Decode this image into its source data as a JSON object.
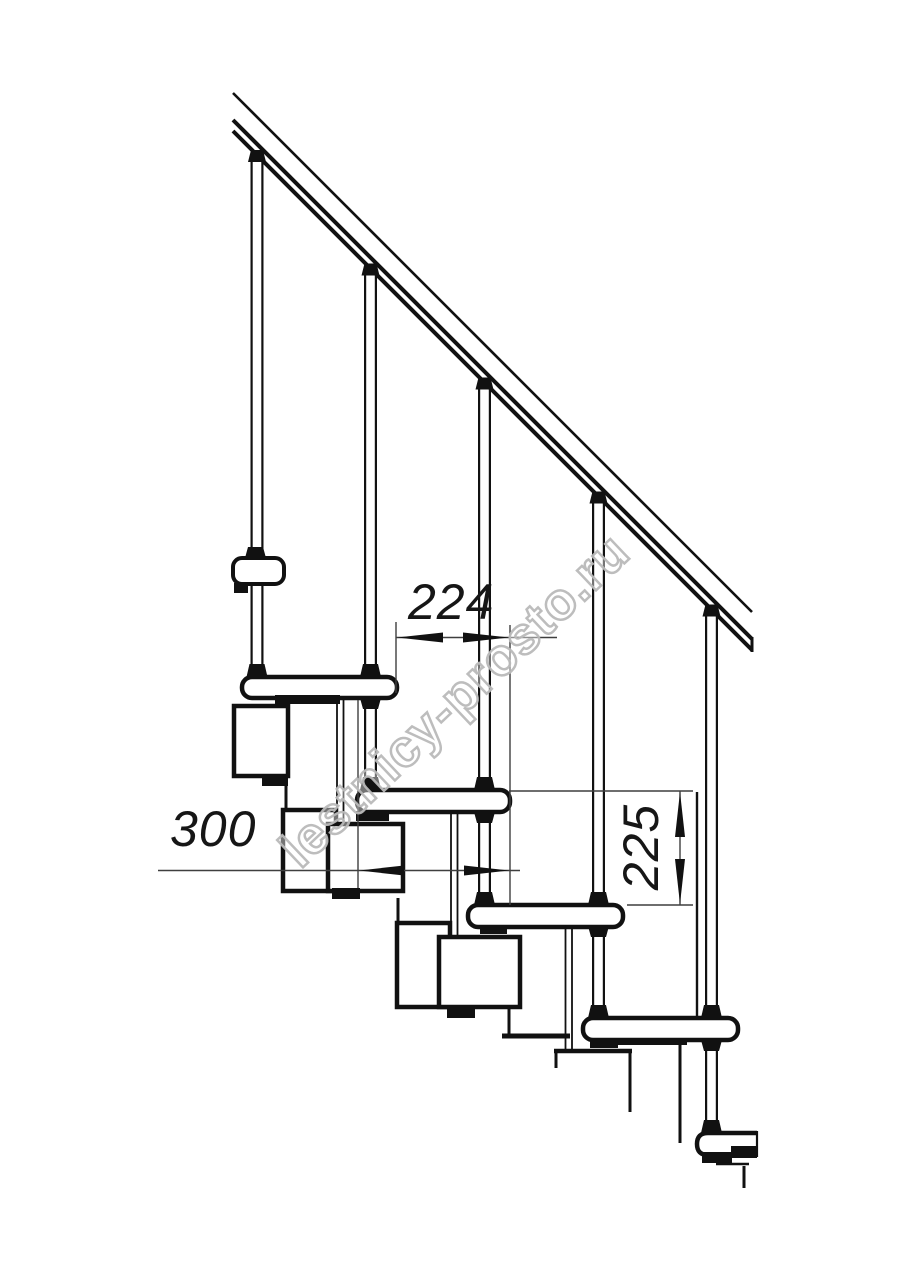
{
  "drawing": {
    "watermark": "lestnicy-prosto.ru",
    "dimensions": {
      "run": "224",
      "depth": "300",
      "riser": "225"
    },
    "colors": {
      "line": "#111111",
      "dimension_line": "#3f3f3f",
      "watermark_outline": "#b9b9b9",
      "background": "#ffffff"
    }
  }
}
